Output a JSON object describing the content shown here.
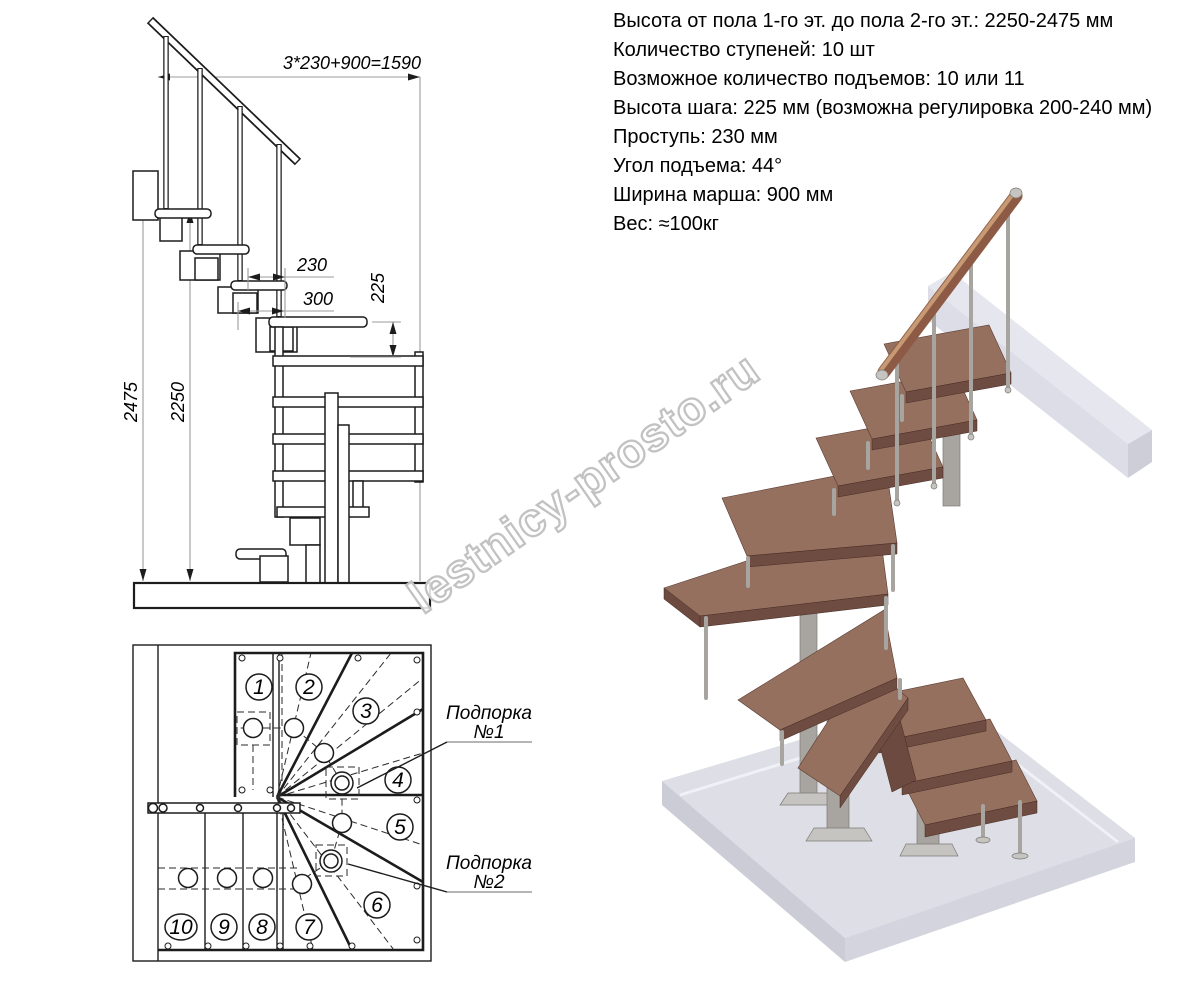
{
  "specs": {
    "lines": [
      "Высота от пола 1-го эт. до пола 2-го эт.: 2250-2475 мм",
      "Количество ступеней: 10 шт",
      "Возможное количество подъемов: 10 или 11",
      "Высота шага: 225 мм (возможна регулировка 200-240 мм)",
      "Проступь: 230 мм",
      "Угол подъема: 44°",
      "Ширина марша: 900 мм",
      "Вес: ≈100кг"
    ]
  },
  "elevation": {
    "dims": {
      "total_run": "3*230+900=1590",
      "tread_depth": "230",
      "module_depth": "300",
      "step_rise": "225",
      "floor_to_floor": "2475",
      "floor_to_top_step": "2250"
    }
  },
  "plan": {
    "step_numbers": [
      "1",
      "2",
      "3",
      "4",
      "5",
      "6",
      "7",
      "8",
      "9",
      "10"
    ],
    "supports": [
      {
        "line1": "Подпорка",
        "line2": "№1"
      },
      {
        "line1": "Подпорка",
        "line2": "№2"
      }
    ]
  },
  "watermark": "lestnicy-prosto.ru",
  "palette": {
    "dim_line": "#9b9b9b",
    "wood_top": "#95705f",
    "wood_edge": "#6f4c41",
    "wood_panel": "#6d4a40",
    "handrail_wood": "#8d5b45",
    "handrail_light": "#c79a74",
    "metal": "#a8a5a0",
    "metal_dark": "#7e7b76",
    "metal_light": "#c6c4c0",
    "slab_top": "#dddee6",
    "slab_left": "#cbccd6",
    "slab_right": "#d3d4dd",
    "beam_top": "#e6e7ee",
    "beam_front": "#dcdde6",
    "beam_end": "#cdced8",
    "watermark": "#c2c2c2"
  }
}
